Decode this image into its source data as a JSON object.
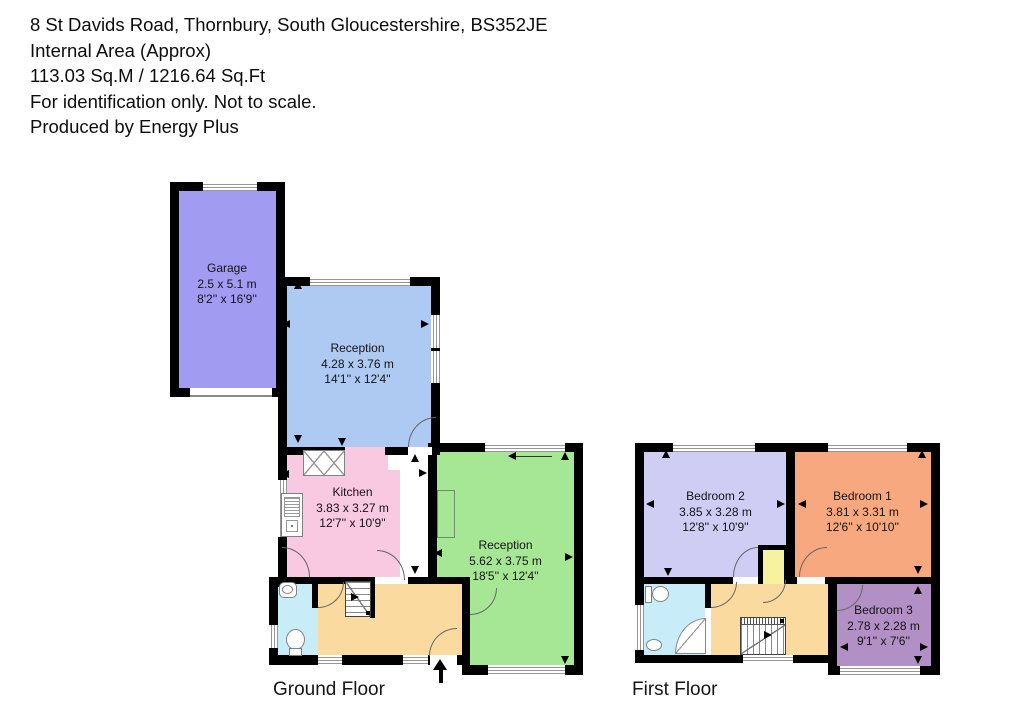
{
  "header": {
    "address": "8 St Davids Road, Thornbury, South Gloucestershire, BS352JE",
    "area_label": "Internal Area (Approx)",
    "area_value": "113.03 Sq.M / 1216.64 Sq.Ft",
    "disclaimer": "For identification only. Not to scale.",
    "producer": "Produced by Energy Plus"
  },
  "floors": {
    "ground": {
      "label": "Ground Floor"
    },
    "first": {
      "label": "First Floor"
    }
  },
  "rooms": {
    "garage": {
      "name": "Garage",
      "metric": "2.5 x 5.1 m",
      "imperial": "8'2'' x 16'9''",
      "color": "#a29bf2"
    },
    "reception1": {
      "name": "Reception",
      "metric": "4.28 x 3.76 m",
      "imperial": "14'1'' x 12'4''",
      "color": "#aecaf2"
    },
    "kitchen": {
      "name": "Kitchen",
      "metric": "3.83 x 3.27 m",
      "imperial": "12'7'' x 10'9''",
      "color": "#f9c9e2"
    },
    "reception2": {
      "name": "Reception",
      "metric": "5.62 x 3.75 m",
      "imperial": "18'5'' x 12'4''",
      "color": "#a6e795"
    },
    "bedroom2": {
      "name": "Bedroom 2",
      "metric": "3.85 x 3.28 m",
      "imperial": "12'8'' x 10'9''",
      "color": "#cfcdf4"
    },
    "bedroom1": {
      "name": "Bedroom 1",
      "metric": "3.81 x 3.31 m",
      "imperial": "12'6'' x 10'10''",
      "color": "#f7a87e"
    },
    "bedroom3": {
      "name": "Bedroom 3",
      "metric": "2.78 x 2.28 m",
      "imperial": "9'1'' x 7'6''",
      "color": "#b290c5"
    }
  },
  "unlabeled_room_colors": {
    "hall_landing": "#fada9f",
    "wc_bathroom": "#c9edf8",
    "stairs_cupboard": "#f6f2a0",
    "walls": "#000000"
  }
}
